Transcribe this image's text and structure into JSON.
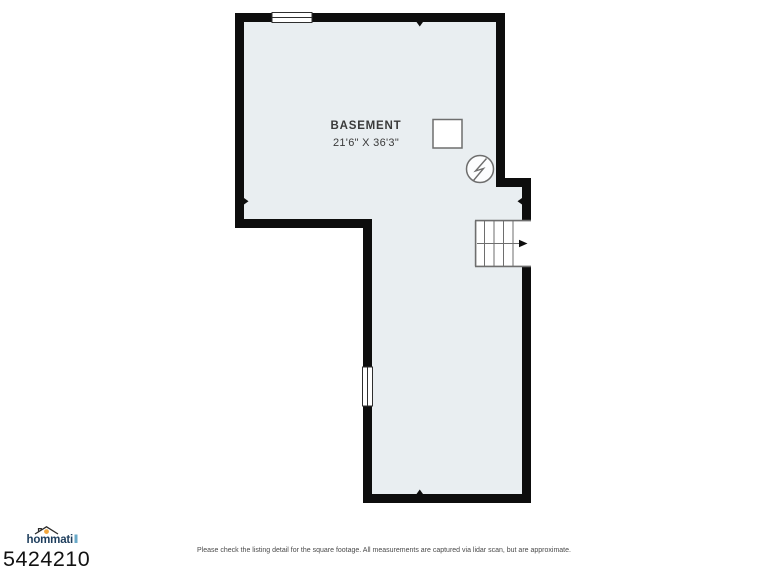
{
  "floorplan": {
    "room_label": "BASEMENT",
    "room_dimensions": "21'6\" X 36'3\"",
    "icons": [
      "window-top-icon",
      "window-left-icon",
      "stairs-icon",
      "stairs-direction-arrow-icon",
      "electrical-panel-icon",
      "support-post-icon",
      "tick-marker-top",
      "tick-marker-left",
      "tick-marker-right",
      "tick-marker-bottom"
    ]
  },
  "footer": {
    "logo_text": "hommati",
    "listing_id": "5424210",
    "disclaimer": "Please check the listing detail for the square footage. All measurements are captured via lidar scan, but are approximate."
  },
  "colors": {
    "wall": "#0d0d0d",
    "floor": "#e9eef1",
    "symbol": "#6e6e6e",
    "window": "#2f2f2f",
    "label": "#3a3a3a",
    "logoNavy": "#1d3d5c",
    "logoOrange": "#f2a63c",
    "logoTeal": "#6aa9c8",
    "listingId": "#121212",
    "disclaimer": "#4a4a4a"
  }
}
